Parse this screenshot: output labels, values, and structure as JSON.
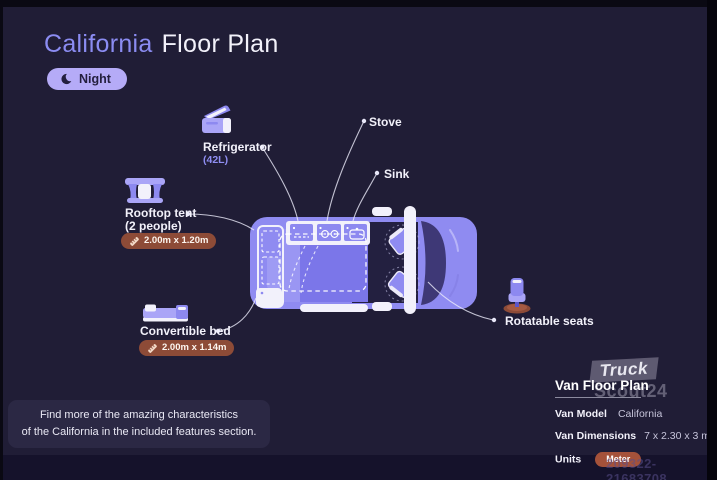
{
  "title": {
    "model": "California",
    "suffix": "Floor Plan"
  },
  "mode_badge": {
    "label": "Night"
  },
  "features": {
    "refrigerator": {
      "label": "Refrigerator",
      "note": "(42L)"
    },
    "stove": {
      "label": "Stove"
    },
    "sink": {
      "label": "Sink"
    },
    "rooftop_tent": {
      "label": "Rooftop tent",
      "note": "(2 people)",
      "dimensions": "2.00m x 1.20m"
    },
    "convertible_bed": {
      "label": "Convertible bed",
      "dimensions": "2.00m x 1.14m"
    },
    "rotatable_seats": {
      "label": "Rotatable seats"
    }
  },
  "info_box": {
    "line1": "Find more of the amazing characteristics",
    "line2": "of the California in the included features section."
  },
  "details_panel": {
    "title": "Van Floor Plan",
    "van_model_label": "Van Model",
    "van_model_value": "California",
    "van_dimensions_label": "Van Dimensions",
    "van_dimensions_value": "7 x 2.30 x 3 m",
    "units_label": "Units",
    "units_value": "Meter"
  },
  "watermark": {
    "line1": "Truck",
    "line2": "Scout24",
    "listing_id": "209322-21683708"
  },
  "colors": {
    "background": "#201d36",
    "accent_purple": "#8b8cf2",
    "van_body": "#8f8bf1",
    "night_pill": "#b5abf7",
    "badge_rust": "#8d4b37",
    "floor_purple": "#7b76e9"
  }
}
